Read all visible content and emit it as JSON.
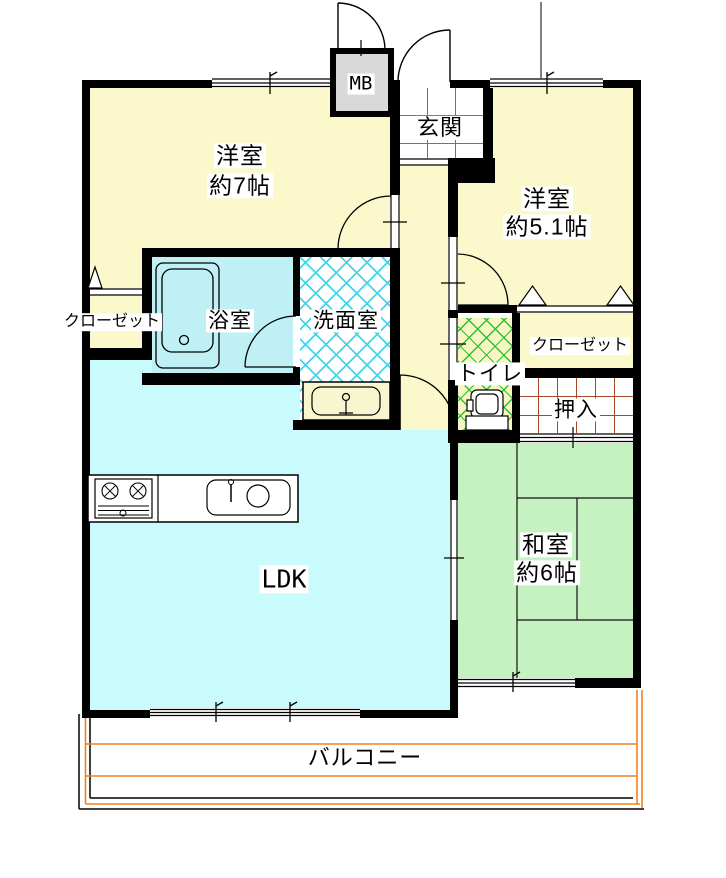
{
  "rooms": {
    "western7": {
      "name": "洋室",
      "area": "約7帖"
    },
    "western51": {
      "name": "洋室",
      "area": "約5.1帖"
    },
    "japanese6": {
      "name": "和室",
      "area": "約6帖"
    },
    "ldk": {
      "name": "LDK"
    },
    "entrance": {
      "name": "玄関"
    },
    "bath": {
      "name": "浴室"
    },
    "washroom": {
      "name": "洗面室"
    },
    "toilet": {
      "name": "トイレ"
    },
    "closet_left": {
      "name": "クローゼット"
    },
    "closet_right": {
      "name": "クローゼット"
    },
    "oshiire": {
      "name": "押入"
    },
    "meter_box": {
      "name": "MB"
    },
    "balcony": {
      "name": "バルコニー"
    }
  },
  "colors": {
    "wall": "#000000",
    "room_yellow": "#FBF8CC",
    "ldk_cyan": "#C9FAFC",
    "bath_blue": "#BFF0F6",
    "tatami_green": "#C6F1C1",
    "toilet_bg": "#F5F6C4",
    "toilet_hatch": "#2FBF2F",
    "washroom_hatch": "#45D4E8",
    "entrance_grid": "#C2572A",
    "oshiire_grid": "#A84826",
    "balcony_orange": "#F08222",
    "meter_gray": "#D9D9D9",
    "sink_counter": "#F9F6CF"
  }
}
